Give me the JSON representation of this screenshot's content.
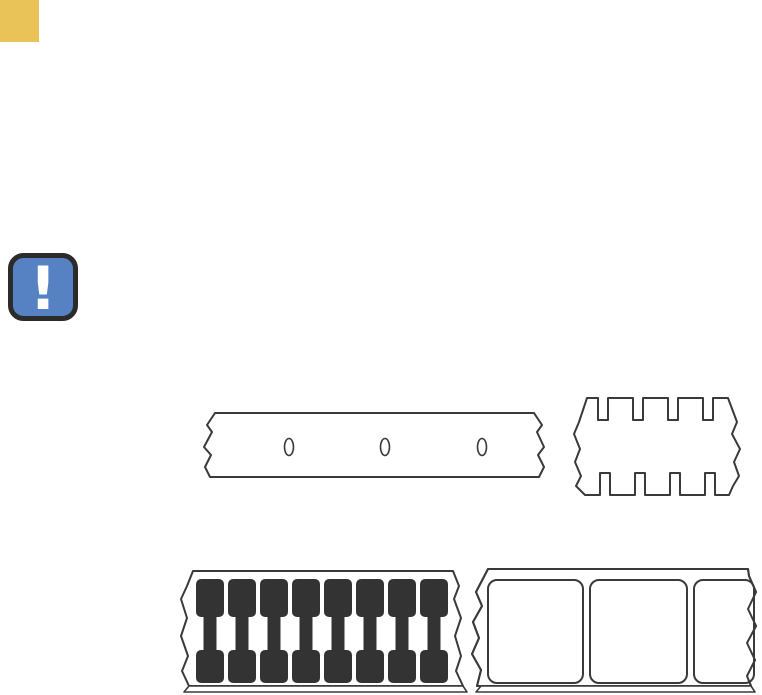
{
  "page": {
    "background": "#ffffff"
  },
  "colors": {
    "accent_yellow": "#e9c357",
    "line": "#3a3a3a",
    "mark_fill": "#333333",
    "note_blue": "#5681c3",
    "note_border": "#2b2b2b",
    "note_glyph_color": "#ffffff"
  },
  "note_icon": {
    "glyph": "!"
  },
  "illustrations": {
    "perforated_media": {
      "holes_x": [
        87,
        183,
        280
      ],
      "holes_y": 38,
      "hole_rx": 4.5,
      "hole_ry": 8.5
    },
    "notched_media": {
      "notch_width": 10,
      "top_notches_x": [
        27,
        62,
        97,
        132
      ],
      "bottom_notches_x": [
        29,
        64,
        99,
        134
      ]
    },
    "black_mark_media": {
      "mark_width": 28,
      "marks_x": [
        18,
        50,
        82,
        114,
        146,
        178,
        210,
        242
      ]
    },
    "gap_web_media": {
      "labels": [
        {
          "x": 20,
          "w": 95
        },
        {
          "x": 122,
          "w": 97
        },
        {
          "x": 226,
          "w": 60
        }
      ]
    }
  }
}
